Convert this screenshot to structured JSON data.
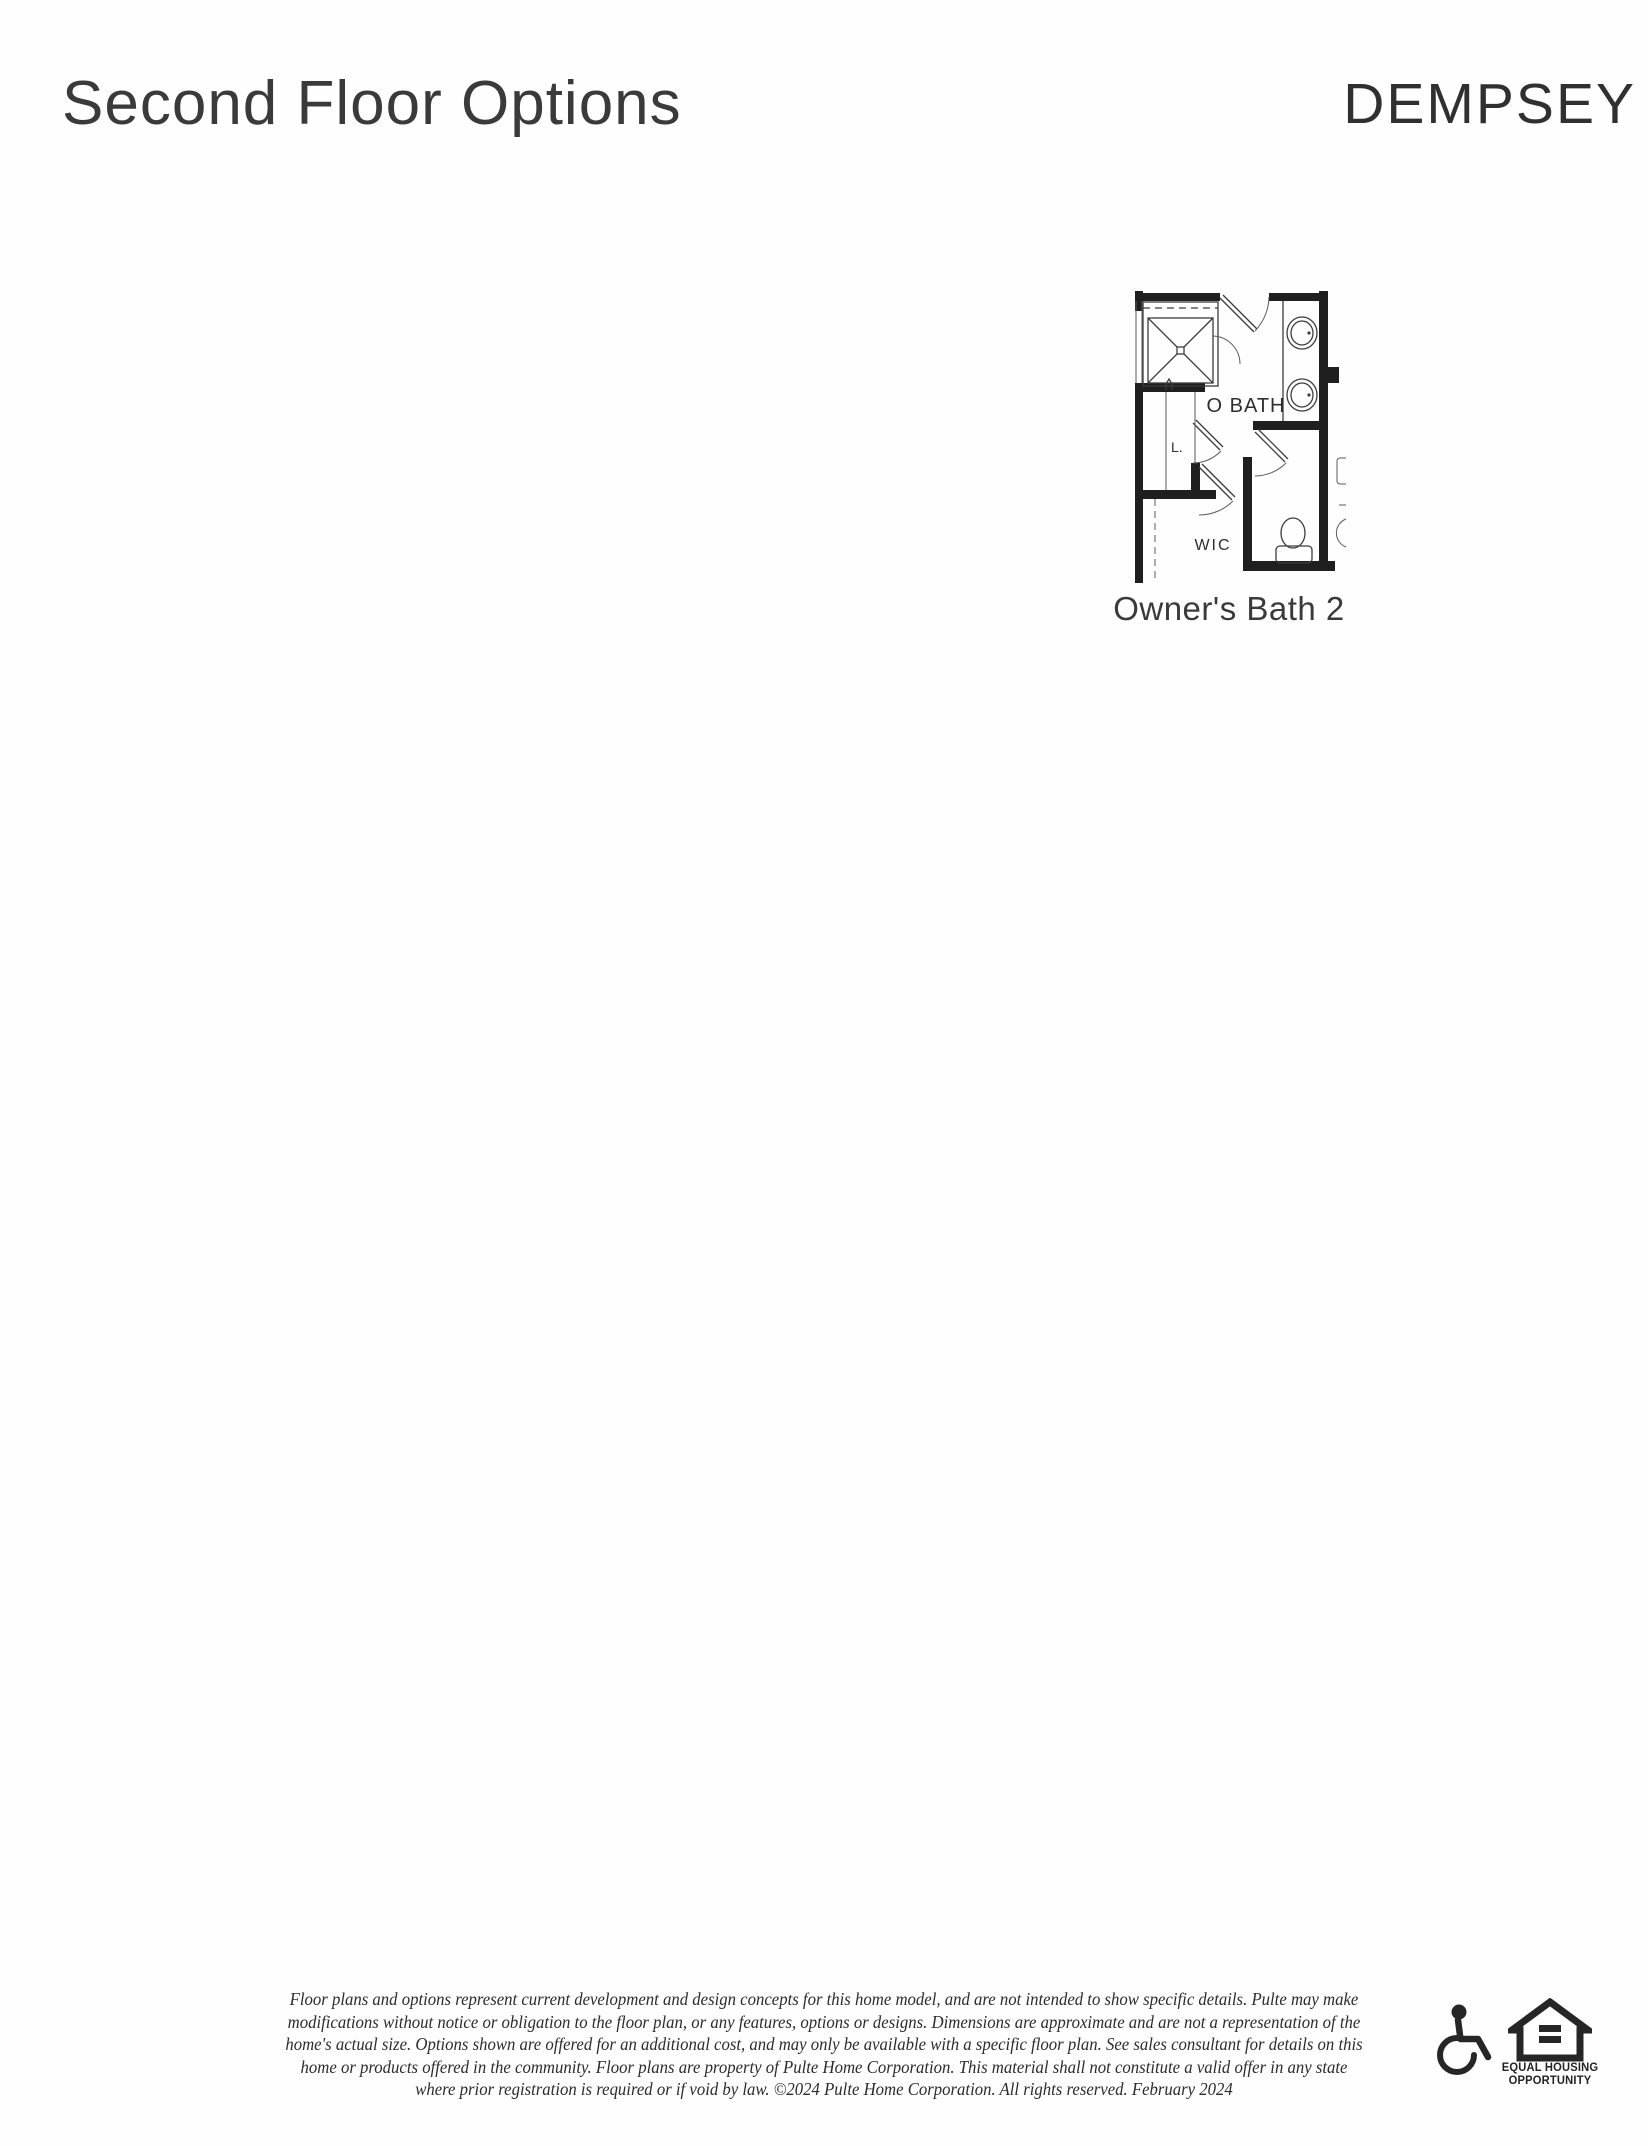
{
  "page": {
    "title": "Second Floor Options",
    "brand": "DEMPSEY"
  },
  "floor_plan": {
    "caption": "Owner's Bath 2",
    "labels": {
      "bath": "O BATH",
      "linen": "L.",
      "wic": "WIC"
    }
  },
  "disclaimer": {
    "lines": [
      "Floor plans and options represent current development and design concepts for this home model, and are not intended to show specific details.  Pulte may make",
      "modifications without notice or obligation to the floor plan, or any features, options or designs.  Dimensions are approximate and are not a representation of the",
      "home's actual size. Options shown are offered for an additional cost, and may only be available with a specific floor plan.  See sales consultant for details on this",
      "home or products offered in the community.  Floor plans are property of Pulte Home Corporation.  This material shall not constitute a valid offer in any state",
      "where prior registration is required or if void by law.   ©2024 Pulte Home Corporation.  All rights reserved.  February 2024"
    ]
  },
  "footer_icons": {
    "accessibility_icon": "wheelchair-icon",
    "equal_housing_icon": "equal-housing-logo",
    "equal_housing_line1": "EQUAL HOUSING",
    "equal_housing_line2": "OPPORTUNITY"
  },
  "colors": {
    "ink": "#2e2e2e",
    "wall": "#1f1f1f",
    "background": "#fefefe"
  }
}
